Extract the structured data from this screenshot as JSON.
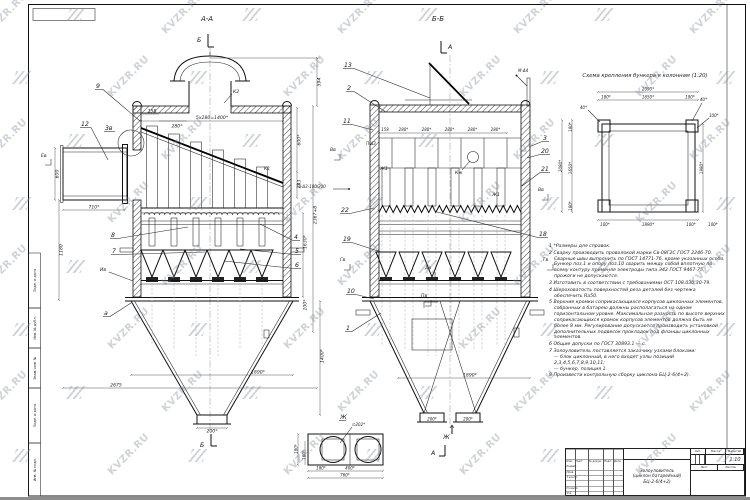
{
  "watermark": {
    "text": "KVZR.RU"
  },
  "frame": {
    "margin_stamps": [
      "Подп. и дата",
      "Инв. № дубл.",
      "Взам. инв. №",
      "Подп. и дата",
      "Инв. № подл."
    ]
  },
  "view_aa": {
    "title": "А-А",
    "marker_b": "Б",
    "dims": {
      "pitch": "5х280=1400*",
      "d158": "158",
      "d280": "280*",
      "h594": "594",
      "h600r": "600*",
      "h243": "243",
      "h_total": "2367+8",
      "h1630": "1630*",
      "h100": "100*",
      "w710": "710*",
      "h600l": "600",
      "h1180": "1180",
      "w1890": "1890*",
      "w2675": "2675",
      "out200": "200*",
      "h1400": "1400*"
    },
    "callouts": {
      "c9": "9",
      "c12": "12",
      "c3v": "3в",
      "c8": "8",
      "c7": "7",
      "c4": "4",
      "c5": "5",
      "c6": "6",
      "ca": "а"
    },
    "labels": {
      "k2": "К2",
      "k1": "К1",
      "iv": "Ив",
      "ev": "Ев"
    }
  },
  "view_bb": {
    "title": "Б-Б",
    "marker_a": "А",
    "marker_zh": "Ж",
    "dims": {
      "d158": "158",
      "d280": "280*",
      "w1890": "1890*",
      "out200": "200*"
    },
    "callouts": {
      "c13": "13",
      "c2": "2",
      "c11": "11",
      "c22": "22",
      "c19": "19",
      "c10": "10",
      "c1": "1",
      "c3": "3",
      "c20": "20",
      "c21": "21",
      "c18": "18"
    },
    "labels": {
      "weld_t2": "Т2-Δ3-100/200",
      "weld_p": "П-Δ3",
      "weld_m": "М-Δ4",
      "zh1": "Ж1",
      "kzh": "Кж",
      "vv": "Вв",
      "gv": "Гв",
      "dv": "Дв",
      "pv": "Пв"
    }
  },
  "view_zh": {
    "title": "Ж",
    "dims": {
      "dia": "∅202*",
      "d180": "180*",
      "d160": "160*",
      "d400": "400*",
      "d760": "760*"
    }
  },
  "scheme": {
    "title": "Схема крепления бункера к колоннам (1:20)",
    "dims": {
      "d2090": "2090*",
      "d180": "180*",
      "d1650": "1650*",
      "d190": "190*",
      "d40": "40*",
      "d100": "100*",
      "d1890": "1890*",
      "d1990": "1990*"
    }
  },
  "notes": [
    "1 *Размеры для справок.",
    "2 Сварку производить проволокой марки Св-08Г2С ГОСТ 2246-70. Сварные швы выполнить по ГОСТ 14771-76, кроме указанных особо. Бункер поз.1 и опору поз.10 сварить между собой вплотную по всему контуру применяя электроды типа Э42 ГОСТ 9467-75, прожоги не допускаются.",
    "3 Изготовить в соответствии с требованиями ОСТ 108.030.30-79.",
    "4 Шероховатость поверхностей реза деталей без чертежа обеспечить Ra50.",
    "5 Верхние кромки соприкасающихся корпусов циклонных элементов, собранных в батарею должны располагаться на одном горизонтальном уровне. Максимальная разность по высоте верхних соприкасающихся кромок корпусов элементов должна быть не более 8 мм. Регулирование допускается производить установкой дополнительных подвесок прокладок под фланцы циклонных элементов.",
    "6 Общие допуски по ГОСТ 30893.1 — с.",
    "7 Золоуловитель поставляется заказчику узлами блоками:\n— блок циклонный, в него входят узлы позиций 2,3,4,5,6,7,8,9,10,11;\n— бункер, позиция 1.",
    "8 Произвести контрольную сборку циклона БЦ-2-6(4+2)."
  ],
  "title_block": {
    "name_l1": "Золоуловитель",
    "name_l2": "(циклон батарейный)",
    "name_l3": "БЦ-2-6(4+2)",
    "scale_value": "1:10",
    "headers": {
      "izm": "Изм.",
      "list": "Лист",
      "dokum": "№ докум.",
      "podp": "Подп.",
      "data": "Дата",
      "razrab": "Разраб.",
      "prov": "Пров.",
      "tkontr": "Т.контр.",
      "nkontr": "Н.контр.",
      "utv": "Утв.",
      "lit": "Лит.",
      "massa": "Масса",
      "masshtab": "Масштаб",
      "list2": "Лист",
      "listov": "Листов"
    }
  }
}
